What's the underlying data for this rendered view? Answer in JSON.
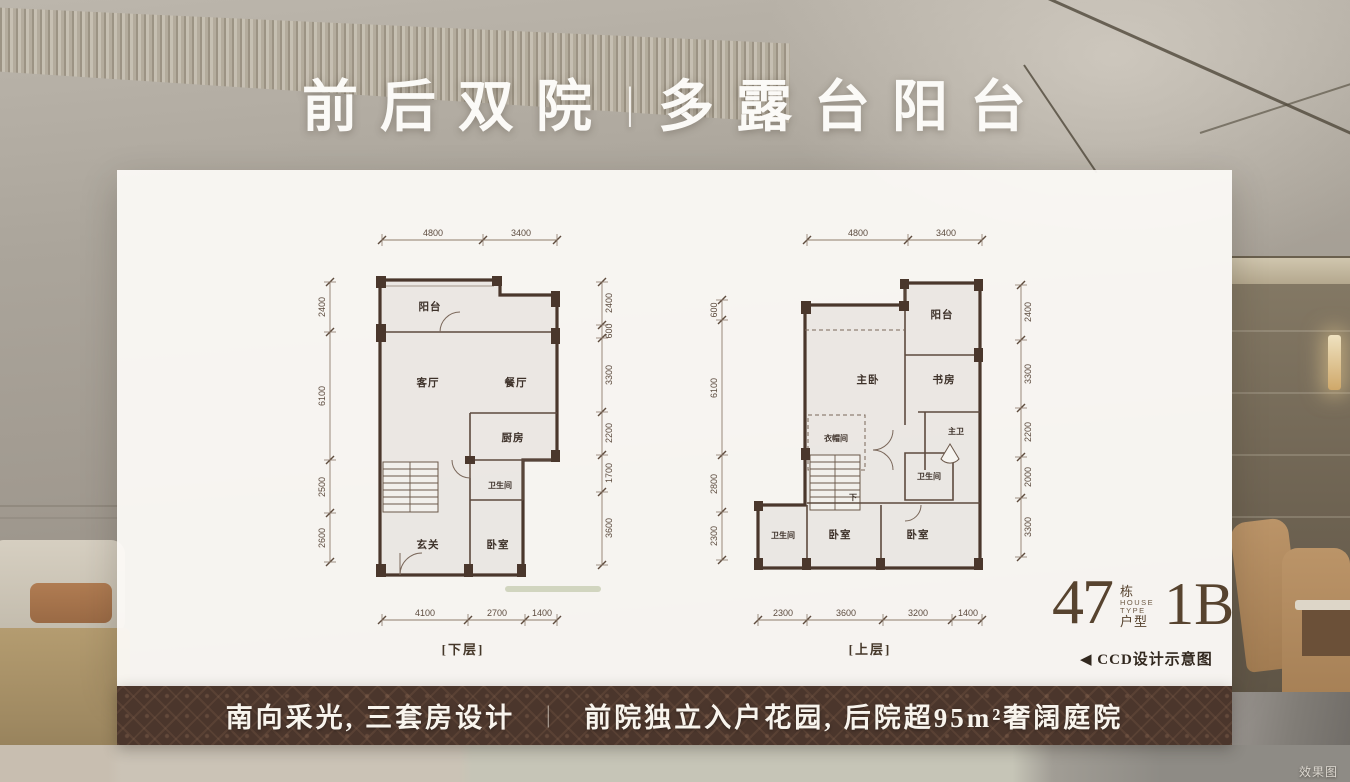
{
  "title": {
    "left": "前后双院",
    "divider": "丨",
    "right": "多露台阳台"
  },
  "plans": {
    "lower": {
      "caption": "[下层]",
      "rooms_main": [
        {
          "t": "阳台",
          "x": 430,
          "y": 310
        },
        {
          "t": "客厅",
          "x": 428,
          "y": 386
        },
        {
          "t": "餐厅",
          "x": 516,
          "y": 386
        },
        {
          "t": "厨房",
          "x": 513,
          "y": 441
        },
        {
          "t": "玄关",
          "x": 428,
          "y": 548
        },
        {
          "t": "卧室",
          "x": 498,
          "y": 548
        }
      ],
      "rooms_small": [
        {
          "t": "卫生间",
          "x": 500,
          "y": 488
        }
      ],
      "dims": {
        "top": [
          {
            "t": "4800",
            "x": 433,
            "y": 236
          },
          {
            "t": "3400",
            "x": 521,
            "y": 236
          }
        ],
        "bottom": [
          {
            "t": "4100",
            "x": 425,
            "y": 616
          },
          {
            "t": "2700",
            "x": 497,
            "y": 616
          },
          {
            "t": "1400",
            "x": 542,
            "y": 616
          }
        ],
        "left": [
          {
            "t": "2400",
            "x": 325,
            "y": 307
          },
          {
            "t": "6100",
            "x": 325,
            "y": 396
          },
          {
            "t": "2500",
            "x": 325,
            "y": 487
          },
          {
            "t": "2600",
            "x": 325,
            "y": 538
          }
        ],
        "right": [
          {
            "t": "2400",
            "x": 612,
            "y": 303
          },
          {
            "t": "600",
            "x": 612,
            "y": 331
          },
          {
            "t": "3300",
            "x": 612,
            "y": 375
          },
          {
            "t": "2200",
            "x": 612,
            "y": 433
          },
          {
            "t": "1700",
            "x": 612,
            "y": 473
          },
          {
            "t": "3600",
            "x": 612,
            "y": 528
          }
        ]
      }
    },
    "upper": {
      "caption": "[上层]",
      "rooms_main": [
        {
          "t": "阳台",
          "x": 942,
          "y": 318
        },
        {
          "t": "主卧",
          "x": 868,
          "y": 383
        },
        {
          "t": "书房",
          "x": 944,
          "y": 383
        },
        {
          "t": "卧室",
          "x": 840,
          "y": 538
        },
        {
          "t": "卧室",
          "x": 918,
          "y": 538
        }
      ],
      "rooms_small": [
        {
          "t": "衣帽间",
          "x": 836,
          "y": 441
        },
        {
          "t": "主卫",
          "x": 956,
          "y": 434
        },
        {
          "t": "卫生间",
          "x": 929,
          "y": 479
        },
        {
          "t": "卫生间",
          "x": 783,
          "y": 538
        },
        {
          "t": "下",
          "x": 853,
          "y": 500
        }
      ],
      "dims": {
        "top": [
          {
            "t": "4800",
            "x": 858,
            "y": 236
          },
          {
            "t": "3400",
            "x": 946,
            "y": 236
          }
        ],
        "bottom": [
          {
            "t": "2300",
            "x": 783,
            "y": 616
          },
          {
            "t": "3600",
            "x": 846,
            "y": 616
          },
          {
            "t": "3200",
            "x": 918,
            "y": 616
          },
          {
            "t": "1400",
            "x": 968,
            "y": 616
          }
        ],
        "left": [
          {
            "t": "600",
            "x": 717,
            "y": 310
          },
          {
            "t": "6100",
            "x": 717,
            "y": 388
          },
          {
            "t": "2800",
            "x": 717,
            "y": 484
          },
          {
            "t": "2300",
            "x": 717,
            "y": 536
          }
        ],
        "right": [
          {
            "t": "2400",
            "x": 1031,
            "y": 312
          },
          {
            "t": "3300",
            "x": 1031,
            "y": 374
          },
          {
            "t": "2200",
            "x": 1031,
            "y": 432
          },
          {
            "t": "2000",
            "x": 1031,
            "y": 477
          },
          {
            "t": "3300",
            "x": 1031,
            "y": 527
          }
        ]
      }
    }
  },
  "type_block": {
    "number": "47",
    "building_label": "栋",
    "house": "HOUSE",
    "type": "TYPE",
    "unit_label": "户型",
    "code": "1B"
  },
  "design_note": "◀ CCD设计示意图",
  "banner": {
    "left": "南向采光, 三套房设计",
    "divider": "｜",
    "right": "前院独立入户花园, 后院超95m²奢阔庭院"
  },
  "watermark": "效果图",
  "colors": {
    "banner_bg": "#4b362c",
    "plan_wall": "#4a372c",
    "type_text": "#57432f",
    "panel_bg": "#fbf9f6",
    "title_text": "#fbfaf7"
  }
}
